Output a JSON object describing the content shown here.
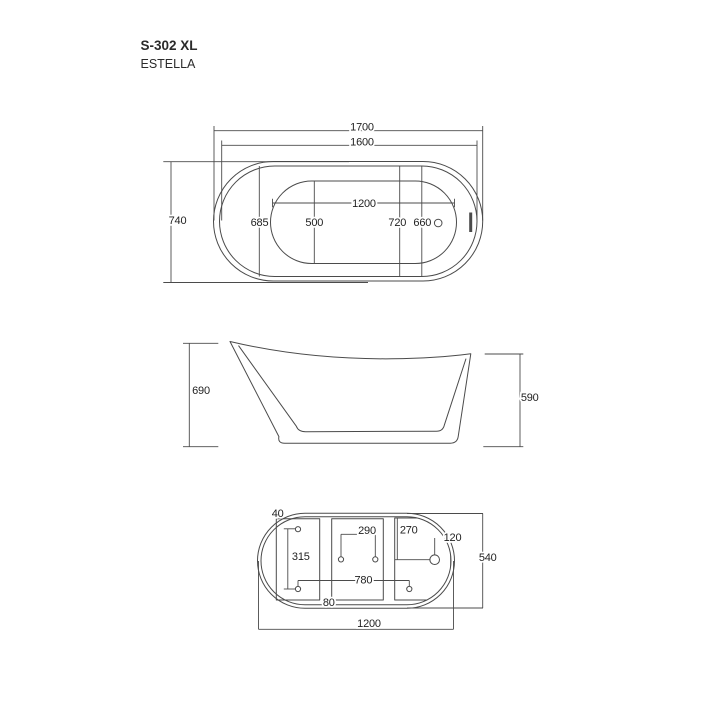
{
  "title": {
    "model": "S-302 XL",
    "series": "ESTELLA"
  },
  "colors": {
    "line": "#4b4b4b",
    "text": "#1f1f1f",
    "bg": "#ffffff"
  },
  "top_view": {
    "overall_length": "1700",
    "rim_length": "1600",
    "overall_width": "740",
    "inner_width": "685",
    "pos_left": "500",
    "basin_length": "1200",
    "pos_right_a": "720",
    "pos_right_b": "660"
  },
  "side_view": {
    "back_height": "690",
    "front_height": "590"
  },
  "bottom_view": {
    "hole_diameter": "40",
    "hole_span_vertical": "315",
    "hole_span_middle": "290",
    "drain_offset_vertical": "270",
    "drain_offset_horizontal": "120",
    "base_width": "540",
    "hole_span_horizontal": "780",
    "panel_gap": "80",
    "base_length": "1200"
  }
}
